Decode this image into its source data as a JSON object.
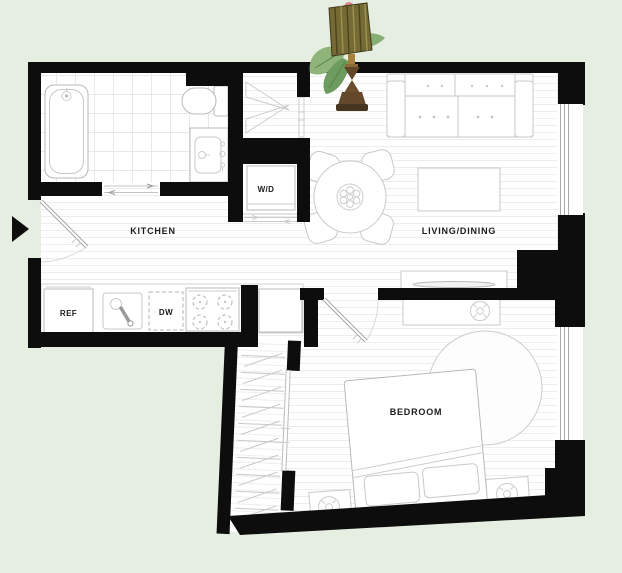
{
  "plan": {
    "type": "apartment-floor-plan",
    "labels": {
      "kitchen": "KITCHEN",
      "living_dining": "LIVING/DINING",
      "bedroom": "BEDROOM",
      "washer_dryer": "W/D",
      "refrigerator": "REF",
      "dishwasher": "DW"
    }
  },
  "icons": {
    "entry_arrow": "right-pointing-triangle-entry-marker"
  },
  "decor": {
    "plant_lamp": "tiki-table-lamp-with-tropical-leaves-and-pink-flower"
  },
  "colors": {
    "background": "#e6eee2",
    "walls": "#0d0d0d",
    "floor": "#ffffff",
    "plank_line": "#ededed",
    "tile_line": "#e8e8e8",
    "fixture_stroke": "#b8b8b8",
    "label_text": "#1c1c1c"
  }
}
